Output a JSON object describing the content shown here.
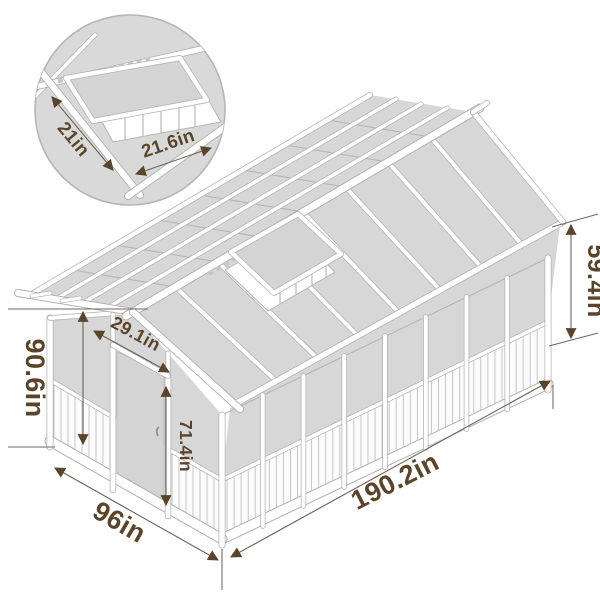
{
  "diagram": {
    "dimensions": {
      "total_height": "90.6in",
      "width": "96in",
      "length": "190.2in",
      "wall_height": "59.4in",
      "door_height": "71.4in",
      "door_width": "29.1in"
    },
    "vent_inset": {
      "panel_width": "21in",
      "opening_width": "21.6in"
    },
    "colors": {
      "label_text": "#5a452b",
      "dimension_line": "#6e675d",
      "panel_fill": "#d7d7d7",
      "frame_outline": "#b0b0b0",
      "frame_fill": "#ffffff",
      "background": "#ffffff"
    }
  }
}
